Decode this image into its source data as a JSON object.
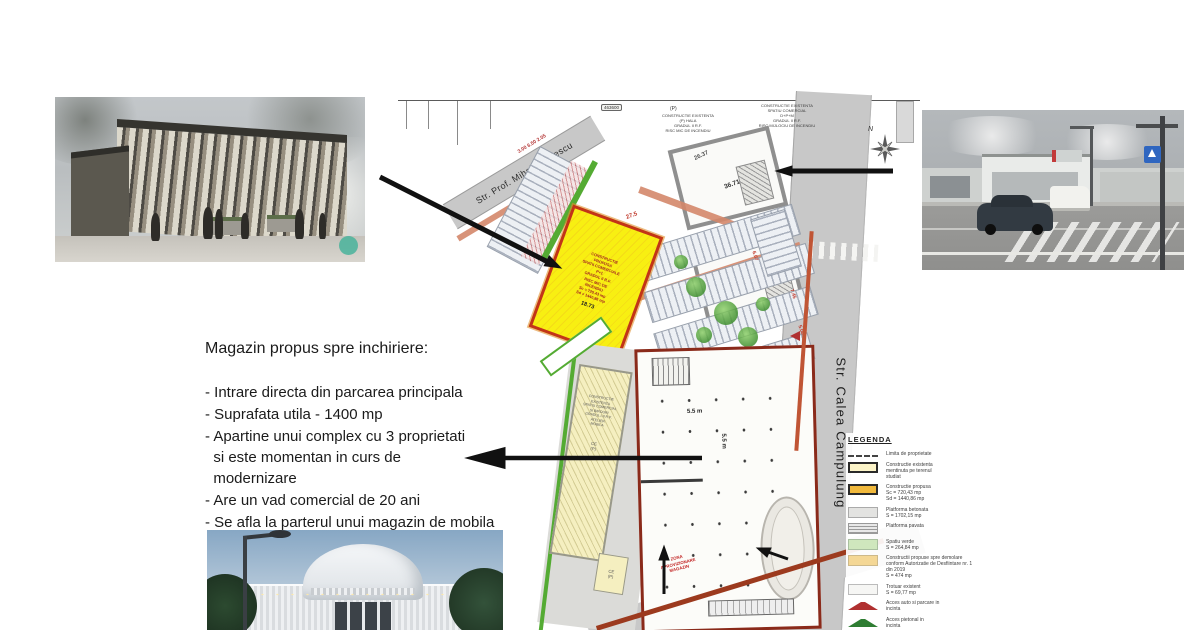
{
  "listing": {
    "title": "Magazin propus spre inchiriere:",
    "bullets": [
      "- Intrare directa din parcarea principala",
      "- Suprafata utila - 1400 mp",
      "- Apartine unui complex cu 3 proprietati\n  si este momentan in curs de\n  modernizare",
      "- Are un vad comercial de 20 ani",
      "- Se afla la parterul unui magazin de mobila"
    ]
  },
  "plan": {
    "streets": {
      "top": "Str. Prof. Mihail Vladescu",
      "right": "Str. Calea Campulung",
      "bottom": "Str. Gen Ioan S. Gheorghe"
    },
    "compass_label": "N",
    "coord_label": "463600",
    "storey_label": "(P)",
    "existing_hall_label": "CONSTRUCTIE EXISTENTA\n(P) HALA\nGRADUL II R.F.\nRISC MIC DE INCENDIU",
    "existing_commercial_label": "CONSTRUCTIE EXISTENTA\nSPATIU COMERCIAL\nD+P+M\nGRADUL II R.F.\nRISC MIJLOCIU DE INCENDIU",
    "existing_commercial2_label": "CONSTRUCTIE EXISTENTA\nSPATIU COMERCIAL\n(P)\nGRADUL II R.F.\nRISC MIC DE INCENDIU",
    "proposed_label": "CONSTRUCTIE\nPROPUSA\nSPATII COMERCIALE\nP+1\nGRADUL II R.F.\nRISC MIC DE\nINCENDIU\nSc = 720,43 mp\nSd = 1440,86 mp",
    "existing_strip_label": "CONSTRUCTIE\nEXISTENTA\nSPATIU COMERCIAL\nSI BIROURI\nGRADUL I-II R.F.\nATELIER\nMOBILA",
    "ce_label": "CE\n(P)",
    "supply_zone_label": "ZONA\nAPROVIZIONARE\nMAGAZIN",
    "dims": {
      "d1873": "18.73",
      "d275": "27.5",
      "d3671": "36.71",
      "d2637": "26.37",
      "d607": "6.07",
      "d745": "7.45",
      "d500": "5.00",
      "d55a": "5.5 m",
      "d55b": "5.5 m",
      "topdims": "3.00  6.50  2.05"
    }
  },
  "legend": {
    "title": "LEGENDA",
    "items": [
      {
        "swatch": "dash-line",
        "color": "#444444",
        "label": "Limita de proprietate"
      },
      {
        "swatch": "existing-yellow",
        "color": "#fcf4c8",
        "label": "Constructie existenta\nmentinuta pe terenul\nstudiat"
      },
      {
        "swatch": "proposed-gold",
        "color": "#f1b93c",
        "label": "Constructie propusa\nSc = 720,43 mp\nSd = 1440,86 mp"
      },
      {
        "swatch": "concrete-gray",
        "color": "#e3e3e1",
        "label": "Platforma betonata\nS = 1702,15 mp"
      },
      {
        "swatch": "hatch-gray",
        "color": "#9a9a9a",
        "label": "Platforma pavata"
      },
      {
        "swatch": "green",
        "color": "#cfe7bd",
        "label": "Spatiu verde\nS = 264,84 mp"
      },
      {
        "swatch": "tan",
        "color": "#f4d795",
        "label": "Constructii propuse spre demolare\nconform Autorizatie de Desfiintare nr. 1\ndin 2019\nS = 474 mp"
      },
      {
        "swatch": "white",
        "color": "#f6f6f4",
        "label": "Trotuar existent\nS = 69,77 mp"
      },
      {
        "swatch": "arrow-red",
        "color": "#b03030",
        "label": "Acces auto si parcare in\nincinta"
      },
      {
        "swatch": "arrow-green",
        "color": "#2e7d32",
        "label": "Acces pietonal in\nincinta"
      },
      {
        "swatch": "arrow-black",
        "color": "#1a1a1a",
        "label": "Acces auto in\nincinta"
      }
    ]
  },
  "colors": {
    "proposed_building_fill": "#f8ef12",
    "proposed_building_border": "#c23418",
    "main_building_border": "#8a2a1a",
    "street_gray": "#c8c8c8",
    "boundary_red": "#9c3a1e",
    "green_accent": "#54ab33",
    "arrow_black": "#111111"
  }
}
